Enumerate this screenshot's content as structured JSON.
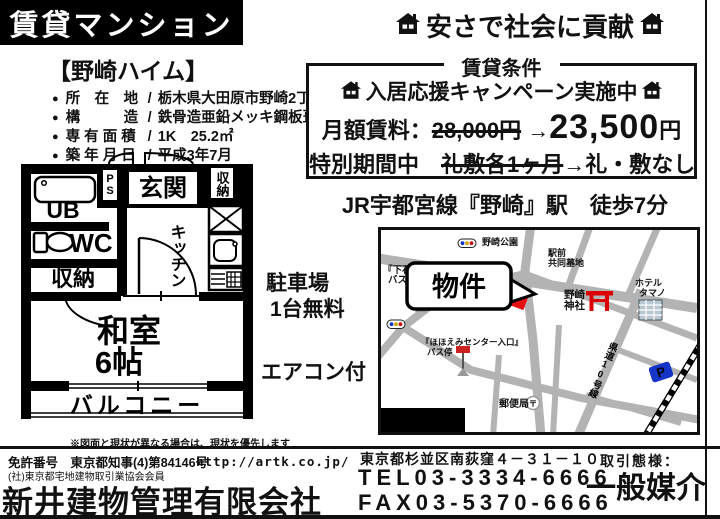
{
  "page": {
    "banner": "賃貸マンション",
    "slogan": "安さで社会に貢献",
    "note": "※図面と現状が異なる場合は、現状を優先します"
  },
  "property": {
    "name": "【野崎ハイム】",
    "bullet": "●",
    "slash": "/",
    "details": [
      {
        "label": "所　在　地",
        "value": "栃木県大田原市野崎2丁目20-9"
      },
      {
        "label": "構　　　造",
        "value": "鉄骨造亜鉛メッキ鋼板葺3階建"
      },
      {
        "label": "専 有 面 積",
        "value": "1K　25.2㎡"
      },
      {
        "label": "築 年 月 日",
        "value": "平成3年7月"
      }
    ],
    "parking_line1": "駐車場",
    "parking_line2": "1台無料",
    "aircon": "エアコン付"
  },
  "conditions": {
    "title": "賃貸条件",
    "campaign": "入居応援キャンペーン実施中",
    "rent_label": "月額賃料：",
    "rent_old": "28,000円",
    "arrow": "→",
    "rent_new": "23,500",
    "yen": "円",
    "special_label": "特別期間中",
    "special_old": "礼敷各1ヶ月",
    "special_new": "礼・敷なし"
  },
  "access": "JR宇都宮線『野崎』駅　徒歩7分",
  "floorplan": {
    "entrance": "玄関",
    "closet_top": "収納",
    "ps": "PS",
    "bath": "UB",
    "toilet": "WC",
    "closet": "収納",
    "kitchen": "キッチン",
    "room_name": "和室",
    "room_size": "6帖",
    "balcony": "バルコニー"
  },
  "map": {
    "legend": "物件地図",
    "callout": "物件",
    "park": "野崎公園",
    "cemetery_l1": "駅前",
    "cemetery_l2": "共同墓地",
    "bus1_l1": "『下石上』",
    "bus1_l2": "バス停",
    "shrine_l1": "野崎",
    "shrine_l2": "神社",
    "hotel_l1": "ホテル",
    "hotel_l2": "タマノ",
    "bus2_l1": "『ほほえみセンター入口』",
    "bus2_l2": "バス停",
    "post_office": "郵便局",
    "post_mark": "〒",
    "road": "県道10号線",
    "parking_mark": "P"
  },
  "footer": {
    "license1": "免許番号　東京都知事(4)第84146号",
    "license2": "(社)東京都宅地建物取引業協会会員",
    "company": "新井建物管理有限会社",
    "url": "http://artk.co.jp/",
    "address": "東京都杉並区南荻窪４－３１－１０",
    "tel": "TEL03-3334-6666",
    "fax": "FAX03-5370-6666",
    "dealing_label": "取引態様：",
    "dealing": "一般媒介"
  },
  "colors": {
    "accent_red": "#dd1111",
    "road_gray": "#b3b3b3",
    "parking_blue": "#1535c8",
    "black": "#000000"
  }
}
